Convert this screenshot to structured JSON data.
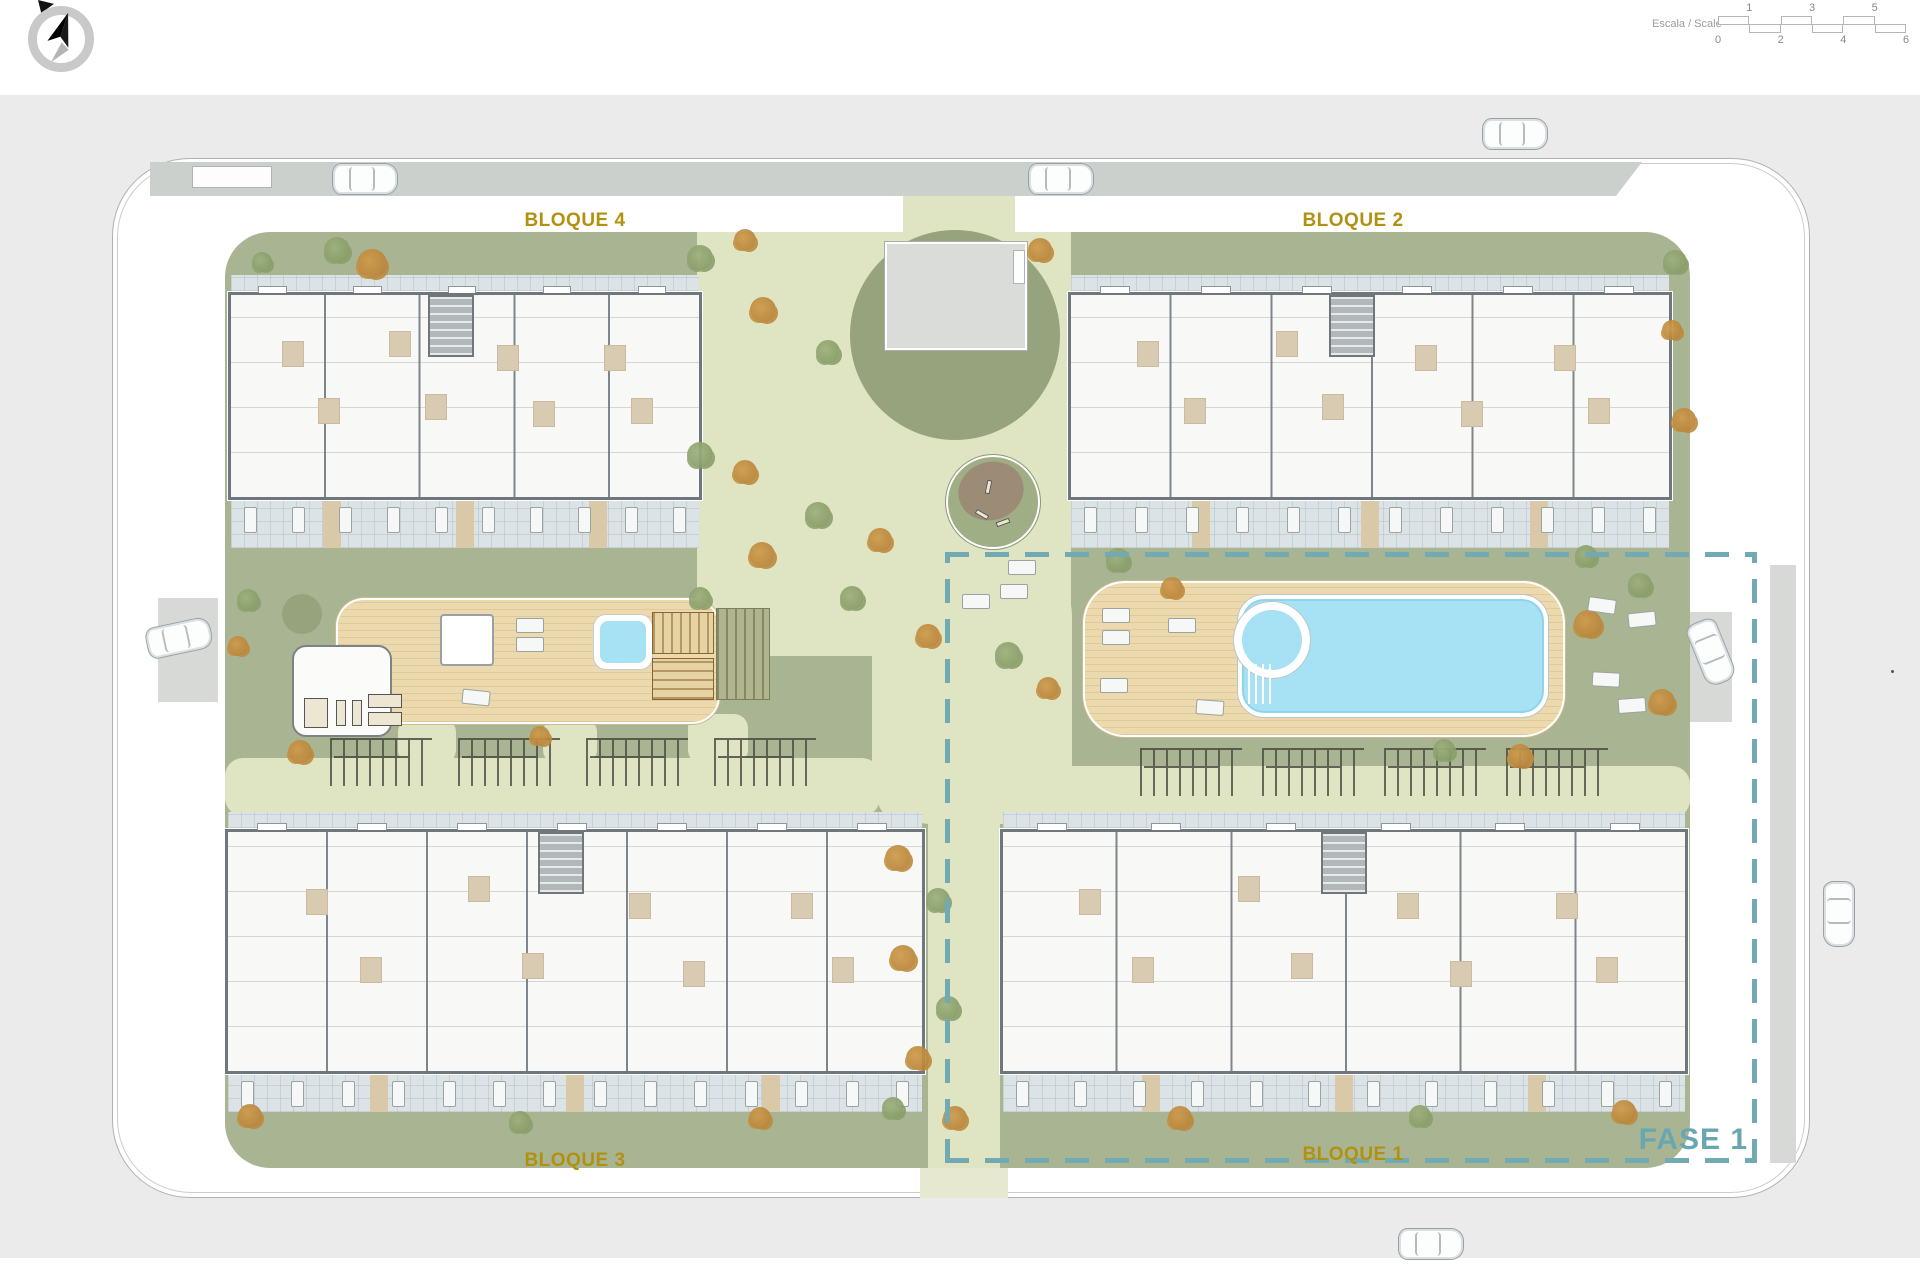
{
  "header": {
    "compass": "north-arrow",
    "scale": {
      "label": "Escala / Scale",
      "top_numbers": [
        "1",
        "3",
        "5"
      ],
      "bottom_numbers": [
        "0",
        "2",
        "4",
        "6"
      ]
    }
  },
  "plan": {
    "labels": {
      "bloque1": "BLOQUE 1",
      "bloque2": "BLOQUE 2",
      "bloque3": "BLOQUE 3",
      "bloque4": "BLOQUE 4",
      "fase": "FASE 1"
    },
    "colors": {
      "background": "#ebebeb",
      "lawn": "#a9b493",
      "lawn_dark": "#96a37c",
      "path": "#dfe4c3",
      "deck_wood": "#ecd9ad",
      "pool_water": "#a6e1f4",
      "terrace_tile": "#dce3e6",
      "building_wall": "#6f767c",
      "road": "#cbd0cd",
      "label_gold": "#b39110",
      "phase_teal": "#68a7b2",
      "tree_green": "#8ba06b",
      "tree_orange": "#c08a3c"
    }
  },
  "scene": {
    "shapes": [
      {
        "c": "road",
        "n": "top-road",
        "x": 150,
        "y": 162,
        "w": 1492,
        "h": 34
      },
      {
        "c": "bay",
        "n": "parking-bay",
        "x": 192,
        "y": 166,
        "w": 80,
        "h": 22
      },
      {
        "c": "pad",
        "n": "parking-pad-left",
        "x": 158,
        "y": 598,
        "w": 60,
        "h": 104
      },
      {
        "c": "pad",
        "n": "parking-pad-right",
        "x": 1666,
        "y": 612,
        "w": 66,
        "h": 110
      },
      {
        "c": "pad",
        "n": "sidewalk-right",
        "x": 1770,
        "y": 565,
        "w": 26,
        "h": 598
      },
      {
        "c": "lawn",
        "n": "garden-lawn",
        "x": 225,
        "y": 232,
        "w": 1465,
        "h": 936,
        "r": 45
      },
      {
        "c": "path",
        "n": "central-path",
        "x": 697,
        "y": 232,
        "w": 374,
        "h": 424
      },
      {
        "c": "path",
        "n": "mid-path",
        "x": 872,
        "y": 556,
        "w": 200,
        "h": 268,
        "r": 60
      },
      {
        "c": "path",
        "n": "west-path-band",
        "x": 225,
        "y": 758,
        "w": 655,
        "h": 58,
        "r": 18
      },
      {
        "c": "path",
        "n": "east-path-band",
        "x": 878,
        "y": 766,
        "w": 812,
        "h": 52,
        "r": 18
      },
      {
        "c": "path",
        "n": "south-corridor",
        "x": 928,
        "y": 806,
        "w": 72,
        "h": 364
      },
      {
        "c": "pathlight",
        "n": "south-exit-path",
        "x": 920,
        "y": 1168,
        "w": 88,
        "h": 30
      },
      {
        "c": "path",
        "n": "north-connector",
        "x": 903,
        "y": 196,
        "w": 112,
        "h": 40
      },
      {
        "c": "lawndark",
        "n": "plaza-circle",
        "x": 850,
        "y": 230,
        "w": 210,
        "h": 210,
        "r": "round"
      },
      {
        "c": "plaza",
        "n": "utility-building",
        "x": 885,
        "y": 242,
        "w": 142,
        "h": 108
      },
      {
        "c": "bay",
        "n": "utility-door",
        "x": 1013,
        "y": 250,
        "w": 12,
        "h": 34
      },
      {
        "c": "path",
        "n": "deck-stub-1",
        "x": 398,
        "y": 718,
        "w": 58,
        "h": 46,
        "r": 14
      },
      {
        "c": "path",
        "n": "deck-stub-2",
        "x": 543,
        "y": 718,
        "w": 54,
        "h": 46,
        "r": 14
      },
      {
        "c": "path",
        "n": "deck-stub-3",
        "x": 688,
        "y": 714,
        "w": 60,
        "h": 50,
        "r": 14
      },
      {
        "c": "lawndark",
        "n": "lawn-circle",
        "x": 282,
        "y": 594,
        "w": 40,
        "h": 40,
        "r": "round"
      },
      {
        "c": "deck",
        "n": "amenity-deck",
        "x": 338,
        "y": 600,
        "w": 380,
        "h": 122,
        "r": 26
      },
      {
        "c": "gym",
        "n": "gym-building",
        "x": 292,
        "y": 645,
        "w": 100,
        "h": 92,
        "r": 14
      },
      {
        "c": "equip",
        "n": "gym-equipment",
        "x": 304,
        "y": 698,
        "w": 24,
        "h": 30
      },
      {
        "c": "equip",
        "n": "gym-equipment",
        "x": 336,
        "y": 700,
        "w": 10,
        "h": 26
      },
      {
        "c": "equip",
        "n": "gym-equipment",
        "x": 352,
        "y": 700,
        "w": 10,
        "h": 26
      },
      {
        "c": "equip",
        "n": "gym-equipment",
        "x": 368,
        "y": 694,
        "w": 34,
        "h": 14
      },
      {
        "c": "equip",
        "n": "gym-equipment",
        "x": 368,
        "y": 712,
        "w": 34,
        "h": 14
      },
      {
        "c": "pergola",
        "n": "pergola",
        "x": 440,
        "y": 614,
        "w": 54,
        "h": 52
      },
      {
        "c": "spaout",
        "n": "spa-surround",
        "x": 594,
        "y": 615,
        "w": 58,
        "h": 54,
        "r": 12
      },
      {
        "c": "spa",
        "n": "spa-pool",
        "x": 600,
        "y": 621,
        "w": 46,
        "h": 42,
        "r": 8
      },
      {
        "c": "crateV",
        "n": "wood-deck-panel",
        "x": 652,
        "y": 612,
        "w": 62,
        "h": 42
      },
      {
        "c": "crateH",
        "n": "wood-deck-panel",
        "x": 652,
        "y": 658,
        "w": 62,
        "h": 42
      },
      {
        "c": "crateS",
        "n": "wood-deck-panel",
        "x": 716,
        "y": 608,
        "w": 54,
        "h": 92
      },
      {
        "c": "deck",
        "n": "pool-deck",
        "x": 1085,
        "y": 583,
        "w": 478,
        "h": 152,
        "r": 40
      },
      {
        "c": "pool",
        "n": "swimming-pool",
        "x": 1238,
        "y": 595,
        "w": 310,
        "h": 122
      },
      {
        "c": "kidsout",
        "n": "kids-pool-surround",
        "x": 1234,
        "y": 602,
        "w": 76,
        "h": 76,
        "r": "round"
      },
      {
        "c": "spa",
        "n": "kids-pool",
        "x": 1242,
        "y": 610,
        "w": 60,
        "h": 60,
        "r": "round"
      },
      {
        "c": "steps",
        "n": "pool-steps",
        "x": 1248,
        "y": 664,
        "w": 28,
        "h": 40
      },
      {
        "c": "play",
        "n": "playground-circle",
        "x": 946,
        "y": 455,
        "w": 94,
        "h": 94,
        "r": "round"
      },
      {
        "c": "playbrown",
        "n": "playground-sand",
        "x": 958,
        "y": 462,
        "w": 66,
        "h": 58,
        "r": "round",
        "o": -18
      },
      {
        "c": "equip",
        "n": "play-equipment",
        "x": 975,
        "y": 512,
        "w": 14,
        "h": 5,
        "o": 30
      },
      {
        "c": "equip",
        "n": "play-equipment",
        "x": 996,
        "y": 520,
        "w": 14,
        "h": 5,
        "o": -20
      },
      {
        "c": "equip",
        "n": "play-equipment",
        "x": 986,
        "y": 480,
        "w": 5,
        "h": 14,
        "o": 12
      },
      {
        "c": "dot",
        "n": "map-dot",
        "x": 1891,
        "y": 670,
        "w": 3,
        "h": 3,
        "r": "round"
      }
    ],
    "buildings": [
      {
        "name": "bloque-4",
        "x": 228,
        "y": 292,
        "w": 474,
        "h": 208,
        "units": 5,
        "core": 0.47,
        "th": 48
      },
      {
        "name": "bloque-2",
        "x": 1068,
        "y": 292,
        "w": 604,
        "h": 208,
        "units": 6,
        "core": 0.47,
        "th": 48
      },
      {
        "name": "bloque-3",
        "x": 225,
        "y": 829,
        "w": 700,
        "h": 245,
        "units": 7,
        "core": 0.48,
        "th": 38
      },
      {
        "name": "bloque-1",
        "x": 1000,
        "y": 829,
        "w": 688,
        "h": 245,
        "units": 6,
        "core": 0.5,
        "th": 38
      }
    ],
    "trellis": [
      [
        330,
        738
      ],
      [
        458,
        738
      ],
      [
        586,
        738
      ],
      [
        714,
        738
      ],
      [
        1140,
        748
      ],
      [
        1262,
        748
      ],
      [
        1384,
        748
      ],
      [
        1506,
        748
      ]
    ],
    "trees": [
      [
        337,
        250,
        13,
        "g"
      ],
      [
        372,
        264,
        15,
        "o"
      ],
      [
        262,
        262,
        10,
        "g"
      ],
      [
        700,
        258,
        13,
        "g"
      ],
      [
        745,
        240,
        11,
        "o"
      ],
      [
        763,
        310,
        13,
        "o"
      ],
      [
        828,
        352,
        12,
        "g"
      ],
      [
        1040,
        250,
        12,
        "o"
      ],
      [
        1675,
        262,
        12,
        "g"
      ],
      [
        1672,
        330,
        10,
        "o"
      ],
      [
        1684,
        420,
        12,
        "o"
      ],
      [
        700,
        455,
        13,
        "g"
      ],
      [
        745,
        472,
        12,
        "o"
      ],
      [
        818,
        515,
        13,
        "g"
      ],
      [
        762,
        555,
        13,
        "o"
      ],
      [
        700,
        598,
        11,
        "g"
      ],
      [
        880,
        540,
        12,
        "o"
      ],
      [
        852,
        598,
        12,
        "g"
      ],
      [
        928,
        636,
        12,
        "o"
      ],
      [
        1008,
        655,
        13,
        "g"
      ],
      [
        1048,
        688,
        11,
        "o"
      ],
      [
        1118,
        560,
        12,
        "g"
      ],
      [
        1172,
        588,
        11,
        "o"
      ],
      [
        248,
        600,
        11,
        "g"
      ],
      [
        238,
        646,
        10,
        "o"
      ],
      [
        1588,
        624,
        14,
        "o"
      ],
      [
        1640,
        585,
        12,
        "g"
      ],
      [
        1662,
        702,
        13,
        "o"
      ],
      [
        1586,
        556,
        11,
        "g"
      ],
      [
        1520,
        756,
        12,
        "o"
      ],
      [
        1444,
        750,
        11,
        "g"
      ],
      [
        300,
        752,
        12,
        "o"
      ],
      [
        540,
        736,
        10,
        "o"
      ],
      [
        898,
        858,
        13,
        "o"
      ],
      [
        938,
        900,
        12,
        "g"
      ],
      [
        903,
        958,
        13,
        "o"
      ],
      [
        948,
        1008,
        12,
        "g"
      ],
      [
        918,
        1058,
        12,
        "o"
      ],
      [
        893,
        1108,
        11,
        "g"
      ],
      [
        955,
        1118,
        12,
        "o"
      ],
      [
        250,
        1116,
        12,
        "o"
      ],
      [
        520,
        1122,
        11,
        "g"
      ],
      [
        760,
        1118,
        11,
        "o"
      ],
      [
        1180,
        1118,
        12,
        "o"
      ],
      [
        1420,
        1116,
        11,
        "g"
      ],
      [
        1624,
        1112,
        12,
        "o"
      ]
    ],
    "loungers": [
      [
        516,
        618,
        0
      ],
      [
        516,
        637,
        0
      ],
      [
        462,
        690,
        6
      ],
      [
        1102,
        608,
        0
      ],
      [
        1102,
        630,
        0
      ],
      [
        1168,
        618,
        0
      ],
      [
        1100,
        678,
        0
      ],
      [
        1196,
        700,
        4
      ],
      [
        1588,
        598,
        8
      ],
      [
        1628,
        612,
        -6
      ],
      [
        1592,
        672,
        3
      ],
      [
        1618,
        698,
        -4
      ],
      [
        1008,
        560,
        0
      ],
      [
        1000,
        584,
        0
      ],
      [
        962,
        594,
        0
      ]
    ],
    "cars": [
      [
        332,
        163,
        0
      ],
      [
        1028,
        163,
        0
      ],
      [
        1482,
        118,
        0
      ],
      [
        146,
        622,
        -12
      ],
      [
        1678,
        636,
        68
      ],
      [
        1806,
        898,
        90
      ],
      [
        1398,
        1228,
        0
      ]
    ],
    "dashes": [
      {
        "c": "dashH",
        "x": 945,
        "y": 552,
        "w": 812,
        "h": 5
      },
      {
        "c": "dashH",
        "x": 945,
        "y": 1158,
        "w": 812,
        "h": 5
      },
      {
        "c": "dashV",
        "x": 945,
        "y": 552,
        "w": 5,
        "h": 611
      },
      {
        "c": "dashV",
        "x": 1752,
        "y": 552,
        "w": 5,
        "h": 611
      }
    ],
    "label_positions": {
      "bloque4": [
        575,
        221
      ],
      "bloque2": [
        1353,
        221
      ],
      "bloque3": [
        575,
        1161
      ],
      "bloque1": [
        1353,
        1155
      ],
      "fase": [
        1748,
        1140
      ]
    }
  }
}
